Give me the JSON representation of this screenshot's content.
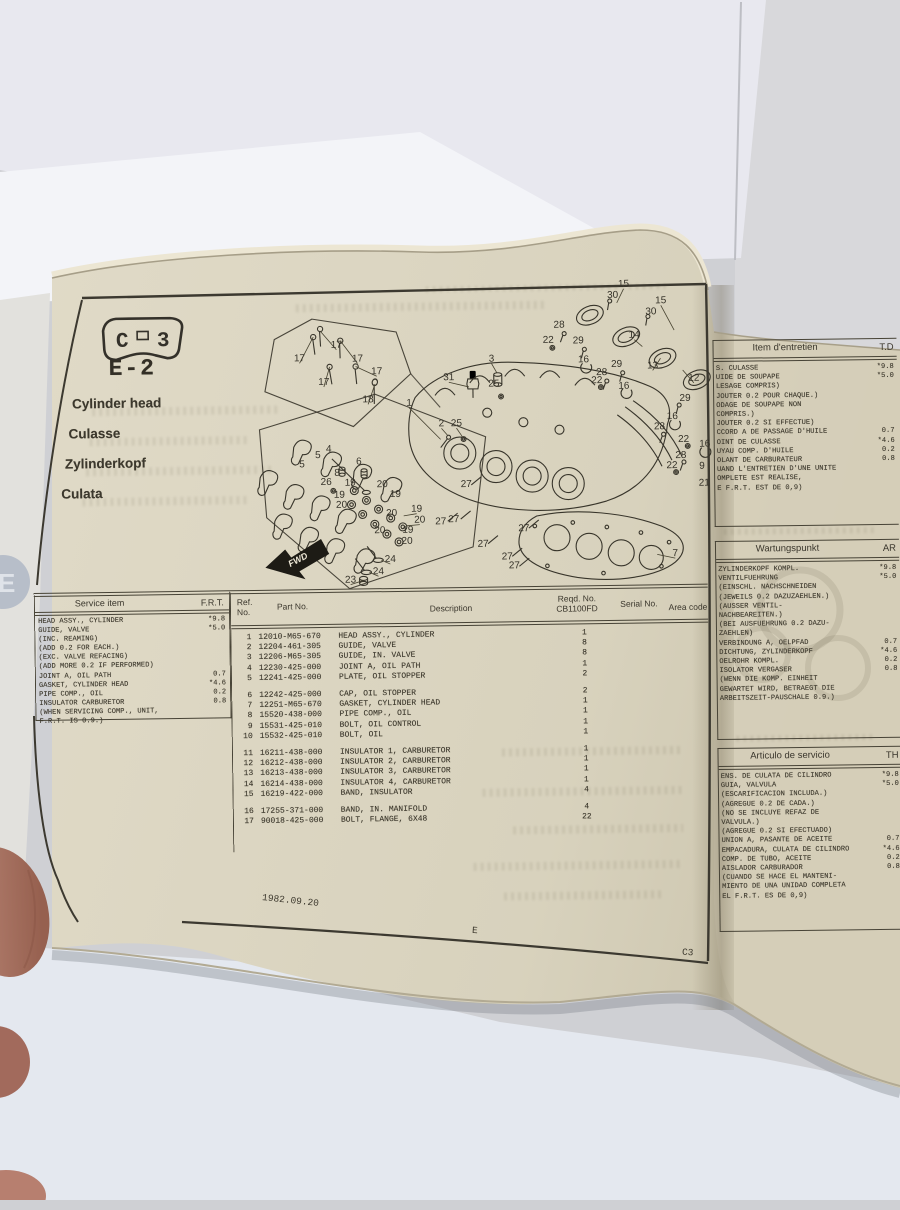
{
  "page": {
    "badge": {
      "left": "C",
      "right": "3"
    },
    "code": "E-2",
    "titles": [
      "Cylinder head",
      "Culasse",
      "Zylinderkopf",
      "Culata"
    ],
    "edge_tab": "E",
    "footer": {
      "date": "1982.09.20",
      "section": "E",
      "page_code": "C3"
    }
  },
  "service_table": {
    "headers": {
      "item": "Service item",
      "frt": "F.R.T."
    },
    "rows": [
      {
        "item": "HEAD ASSY., CYLINDER",
        "frt": "*9.8"
      },
      {
        "item": "GUIDE, VALVE",
        "frt": "*5.0"
      },
      {
        "item": "(INC. REAMING)",
        "frt": ""
      },
      {
        "item": "(ADD 0.2 FOR EACH.)",
        "frt": ""
      },
      {
        "item": "(EXC. VALVE REFACING)",
        "frt": ""
      },
      {
        "item": "(ADD MORE 0.2 IF PERFORMED)",
        "frt": ""
      },
      {
        "item": "JOINT A, OIL PATH",
        "frt": "0.7"
      },
      {
        "item": "GASKET, CYLINDER HEAD",
        "frt": "*4.6"
      },
      {
        "item": "PIPE COMP., OIL",
        "frt": "0.2"
      },
      {
        "item": "INSULATOR CARBURETOR",
        "frt": "0.8"
      },
      {
        "item": "(WHEN SERVICING COMP., UNIT,",
        "frt": ""
      },
      {
        "item": "F.R.T. IS 0.9.)",
        "frt": ""
      }
    ]
  },
  "parts_table": {
    "headers": {
      "ref1": "Ref.",
      "ref2": "No.",
      "part": "Part No.",
      "desc": "Description",
      "reqd1": "Reqd. No.",
      "reqd2": "CB1100FD",
      "serial": "Serial No.",
      "area": "Area code"
    },
    "rows": [
      {
        "ref": "1",
        "part": "12010-M65-670",
        "desc": "HEAD ASSY., CYLINDER",
        "qty": "1",
        "gap": false
      },
      {
        "ref": "2",
        "part": "12204-461-305",
        "desc": "GUIDE, VALVE",
        "qty": "8",
        "gap": false
      },
      {
        "ref": "3",
        "part": "12206-M65-305",
        "desc": "GUIDE, IN. VALVE",
        "qty": "8",
        "gap": false
      },
      {
        "ref": "4",
        "part": "12230-425-000",
        "desc": "JOINT A, OIL PATH",
        "qty": "1",
        "gap": false
      },
      {
        "ref": "5",
        "part": "12241-425-000",
        "desc": "PLATE, OIL STOPPER",
        "qty": "2",
        "gap": false
      },
      {
        "ref": "6",
        "part": "12242-425-000",
        "desc": "CAP, OIL STOPPER",
        "qty": "2",
        "gap": true
      },
      {
        "ref": "7",
        "part": "12251-M65-670",
        "desc": "GASKET, CYLINDER HEAD",
        "qty": "1",
        "gap": false
      },
      {
        "ref": "8",
        "part": "15520-438-000",
        "desc": "PIPE COMP., OIL",
        "qty": "1",
        "gap": false
      },
      {
        "ref": "9",
        "part": "15531-425-010",
        "desc": "BOLT, OIL CONTROL",
        "qty": "1",
        "gap": false
      },
      {
        "ref": "10",
        "part": "15532-425-010",
        "desc": "BOLT, OIL",
        "qty": "1",
        "gap": false
      },
      {
        "ref": "11",
        "part": "16211-438-000",
        "desc": "INSULATOR 1, CARBURETOR",
        "qty": "1",
        "gap": true
      },
      {
        "ref": "12",
        "part": "16212-438-000",
        "desc": "INSULATOR 2, CARBURETOR",
        "qty": "1",
        "gap": false
      },
      {
        "ref": "13",
        "part": "16213-438-000",
        "desc": "INSULATOR 3, CARBURETOR",
        "qty": "1",
        "gap": false
      },
      {
        "ref": "14",
        "part": "16214-438-000",
        "desc": "INSULATOR 4, CARBURETOR",
        "qty": "1",
        "gap": false
      },
      {
        "ref": "15",
        "part": "16219-422-000",
        "desc": "BAND, INSULATOR",
        "qty": "4",
        "gap": false
      },
      {
        "ref": "16",
        "part": "17255-371-000",
        "desc": "BAND, IN. MANIFOLD",
        "qty": "4",
        "gap": true
      },
      {
        "ref": "17",
        "part": "90018-425-000",
        "desc": "BOLT, FLANGE, 6X48",
        "qty": "22",
        "gap": false
      }
    ]
  },
  "lang_tables": [
    {
      "title": "Item d'entretien",
      "col": "T.D",
      "rows": [
        {
          "t": "S. CULASSE",
          "v": "*9.8"
        },
        {
          "t": "UIDE DE SOUPAPE",
          "v": "*5.0"
        },
        {
          "t": "LESAGE COMPRIS)",
          "v": ""
        },
        {
          "t": "JOUTER 0.2 POUR CHAQUE.)",
          "v": ""
        },
        {
          "t": "ODAGE DE SOUPAPE NON",
          "v": ""
        },
        {
          "t": "COMPRIS.)",
          "v": ""
        },
        {
          "t": "JOUTER 0.2 SI EFFECTUE)",
          "v": ""
        },
        {
          "t": "CCORD A DE PASSAGE D'HUILE",
          "v": "0.7"
        },
        {
          "t": "OINT DE CULASSE",
          "v": "*4.6"
        },
        {
          "t": "UYAU COMP. D'HUILE",
          "v": "0.2"
        },
        {
          "t": "OLANT DE CARBURATEUR",
          "v": "0.8"
        },
        {
          "t": "UAND L'ENTRETIEN D'UNE UNITE",
          "v": ""
        },
        {
          "t": "OMPLETE EST REALISE,",
          "v": ""
        },
        {
          "t": "E F.R.T. EST DE 0,9)",
          "v": ""
        }
      ]
    },
    {
      "title": "Wartungspunkt",
      "col": "AR",
      "rows": [
        {
          "t": "ZYLINDERKOPF KOMPL.",
          "v": "*9.8"
        },
        {
          "t": "VENTILFUEHRUNG",
          "v": "*5.0"
        },
        {
          "t": "(EINSCHL. NACHSCHNEIDEN",
          "v": ""
        },
        {
          "t": "(JEWEILS 0.2 DAZUZAEHLEN.)",
          "v": ""
        },
        {
          "t": "(AUSSER VENTIL-",
          "v": ""
        },
        {
          "t": " NACHBEAREITEN.)",
          "v": ""
        },
        {
          "t": "(BEI AUSFUEHRUNG 0.2 DAZU-",
          "v": ""
        },
        {
          "t": "ZAEHLEN)",
          "v": ""
        },
        {
          "t": "VERBINDUNG A, OELPFAD",
          "v": "0.7"
        },
        {
          "t": "DICHTUNG, ZYLINDERKOPF",
          "v": "*4.6"
        },
        {
          "t": "OELROHR KOMPL.",
          "v": "0.2"
        },
        {
          "t": "ISOLATOR VERGASER",
          "v": "0.8"
        },
        {
          "t": "(WENN DIE KOMP. EINHEIT",
          "v": ""
        },
        {
          "t": " GEWARTET WIRD, BETRAEGT DIE",
          "v": ""
        },
        {
          "t": "ARBEITSZEIT-PAUSCHALE 0.9.)",
          "v": ""
        }
      ]
    },
    {
      "title": "Articulo de servicio",
      "col": "TH",
      "rows": [
        {
          "t": "ENS. DE CULATA DE CILINDRO",
          "v": "*9.8"
        },
        {
          "t": "GUIA, VALVULA",
          "v": "*5.0"
        },
        {
          "t": "(ESCARIFICACION INCLUDA.)",
          "v": ""
        },
        {
          "t": "(AGREGUE 0.2 DE CADA.)",
          "v": ""
        },
        {
          "t": "(NO SE INCLUYE REFAZ DE",
          "v": ""
        },
        {
          "t": " VALVULA.)",
          "v": ""
        },
        {
          "t": "(AGREGUE 0.2 SI EFECTUADO)",
          "v": ""
        },
        {
          "t": "UNION A, PASANTE DE ACEITE",
          "v": "0.7"
        },
        {
          "t": "EMPACADURA, CULATA DE CILINDRO",
          "v": "*4.6"
        },
        {
          "t": "COMP. DE TUBO, ACEITE",
          "v": "0.2"
        },
        {
          "t": "AISLADOR CARBURADOR",
          "v": "0.8"
        },
        {
          "t": "(CUANDO SE HACE EL MANTENI-",
          "v": ""
        },
        {
          "t": " MIENTO DE UNA UNIDAD COMPLETA",
          "v": ""
        },
        {
          "t": "EL F.R.T. ES DE 0,9)",
          "v": ""
        }
      ]
    }
  ],
  "diagram": {
    "fwd": "FWD",
    "callouts": [
      {
        "n": "17",
        "x": 102,
        "y": 69,
        "lead": [
          86,
          52
        ]
      },
      {
        "n": "17",
        "x": 65,
        "y": 82,
        "lead": [
          79,
          58
        ]
      },
      {
        "n": "17",
        "x": 123,
        "y": 83,
        "lead": [
          106,
          62
        ]
      },
      {
        "n": "17",
        "x": 142,
        "y": 96,
        "lead": [
          121,
          88
        ]
      },
      {
        "n": "17",
        "x": 89,
        "y": 106,
        "lead": [
          95,
          88
        ]
      },
      {
        "n": "18",
        "x": 133,
        "y": 124,
        "lead": [
          140,
          106
        ]
      },
      {
        "n": "1",
        "x": 174,
        "y": 128,
        "lead": [
          205,
          162
        ]
      },
      {
        "n": "15",
        "x": 390,
        "y": 12,
        "lead": [
          383,
          28
        ]
      },
      {
        "n": "30",
        "x": 379,
        "y": 23
      },
      {
        "n": "15",
        "x": 427,
        "y": 29,
        "lead": [
          440,
          56
        ]
      },
      {
        "n": "30",
        "x": 417,
        "y": 40
      },
      {
        "n": "28",
        "x": 325,
        "y": 52
      },
      {
        "n": "22",
        "x": 314,
        "y": 67
      },
      {
        "n": "29",
        "x": 344,
        "y": 68
      },
      {
        "n": "16",
        "x": 349,
        "y": 87
      },
      {
        "n": "14",
        "x": 400,
        "y": 63,
        "lead": [
          408,
          72
        ]
      },
      {
        "n": "29",
        "x": 382,
        "y": 92
      },
      {
        "n": "13",
        "x": 418,
        "y": 94,
        "lead": [
          426,
          84
        ]
      },
      {
        "n": "28",
        "x": 367,
        "y": 100
      },
      {
        "n": "22",
        "x": 362,
        "y": 108
      },
      {
        "n": "16",
        "x": 389,
        "y": 114
      },
      {
        "n": "12",
        "x": 459,
        "y": 107,
        "lead": [
          448,
          96
        ]
      },
      {
        "n": "29",
        "x": 450,
        "y": 127
      },
      {
        "n": "16",
        "x": 437,
        "y": 145
      },
      {
        "n": "28",
        "x": 424,
        "y": 155
      },
      {
        "n": "22",
        "x": 448,
        "y": 168
      },
      {
        "n": "28",
        "x": 445,
        "y": 184
      },
      {
        "n": "22",
        "x": 436,
        "y": 194
      },
      {
        "n": "16",
        "x": 469,
        "y": 173
      },
      {
        "n": "9",
        "x": 466,
        "y": 195
      },
      {
        "n": "21",
        "x": 468,
        "y": 212
      },
      {
        "n": "3",
        "x": 257,
        "y": 85,
        "lead": [
          262,
          96
        ]
      },
      {
        "n": "25",
        "x": 259,
        "y": 110
      },
      {
        "n": "31",
        "x": 214,
        "y": 103,
        "lead": [
          234,
          110
        ]
      },
      {
        "n": "2",
        "x": 206,
        "y": 149,
        "lead": [
          212,
          158
        ]
      },
      {
        "n": "25",
        "x": 221,
        "y": 149,
        "lead": [
          227,
          160
        ]
      },
      {
        "n": "5",
        "x": 66,
        "y": 188
      },
      {
        "n": "5",
        "x": 82,
        "y": 179
      },
      {
        "n": "4",
        "x": 93,
        "y": 173
      },
      {
        "n": "26",
        "x": 90,
        "y": 206
      },
      {
        "n": "8",
        "x": 101,
        "y": 197
      },
      {
        "n": "6",
        "x": 123,
        "y": 186
      },
      {
        "n": "19",
        "x": 114,
        "y": 207
      },
      {
        "n": "20",
        "x": 146,
        "y": 209
      },
      {
        "n": "19",
        "x": 103,
        "y": 219
      },
      {
        "n": "20",
        "x": 105,
        "y": 229
      },
      {
        "n": "19",
        "x": 159,
        "y": 219
      },
      {
        "n": "20",
        "x": 155,
        "y": 238
      },
      {
        "n": "19",
        "x": 180,
        "y": 234,
        "lead": [
          167,
          238
        ]
      },
      {
        "n": "20",
        "x": 183,
        "y": 245,
        "lead": [
          170,
          248
        ]
      },
      {
        "n": "19",
        "x": 171,
        "y": 255
      },
      {
        "n": "20",
        "x": 143,
        "y": 255
      },
      {
        "n": "20",
        "x": 170,
        "y": 266
      },
      {
        "n": "24",
        "x": 153,
        "y": 284,
        "lead": [
          144,
          282
        ]
      },
      {
        "n": "24",
        "x": 141,
        "y": 296,
        "lead": [
          132,
          294
        ]
      },
      {
        "n": "23",
        "x": 113,
        "y": 304,
        "lead": [
          126,
          302
        ]
      },
      {
        "n": "27",
        "x": 230,
        "y": 210
      },
      {
        "n": "27",
        "x": 204,
        "y": 247
      },
      {
        "n": "27",
        "x": 217,
        "y": 245
      },
      {
        "n": "27",
        "x": 287,
        "y": 255
      },
      {
        "n": "27",
        "x": 246,
        "y": 270
      },
      {
        "n": "27",
        "x": 270,
        "y": 283
      },
      {
        "n": "27",
        "x": 277,
        "y": 292
      },
      {
        "n": "7",
        "x": 438,
        "y": 282,
        "lead": [
          420,
          280
        ]
      }
    ]
  }
}
